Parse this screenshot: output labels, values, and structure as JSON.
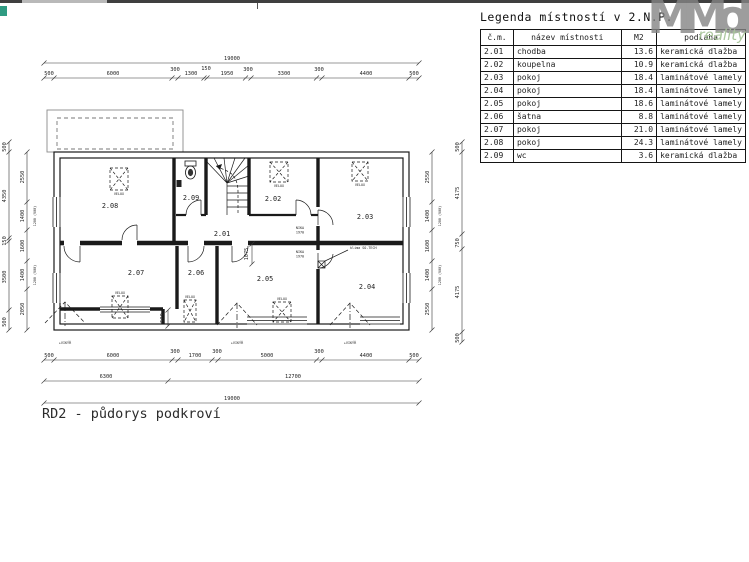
{
  "page": {
    "title_block": "RD2 - půdorys podkroví"
  },
  "watermark": {
    "logo": "MMoli",
    "sub": "reality"
  },
  "legend": {
    "title": "Legenda místností v 2.N.P.",
    "headers": [
      "č.m.",
      "název místnosti",
      "M2",
      "podlaha"
    ],
    "rows": [
      [
        "2.01",
        "chodba",
        "13.6",
        "keramická dlažba"
      ],
      [
        "2.02",
        "koupelna",
        "10.9",
        "keramická dlažba"
      ],
      [
        "2.03",
        "pokoj",
        "18.4",
        "laminátové lamely"
      ],
      [
        "2.04",
        "pokoj",
        "18.4",
        "laminátové lamely"
      ],
      [
        "2.05",
        "pokoj",
        "18.6",
        "laminátové lamely"
      ],
      [
        "2.06",
        "šatna",
        "8.8",
        "laminátové lamely"
      ],
      [
        "2.07",
        "pokoj",
        "21.0",
        "laminátové lamely"
      ],
      [
        "2.08",
        "pokoj",
        "24.3",
        "laminátové lamely"
      ],
      [
        "2.09",
        "wc",
        "3.6",
        "keramická dlažba"
      ]
    ]
  },
  "plan": {
    "rooms": {
      "r201": "2.01",
      "r202": "2.02",
      "r203": "2.03",
      "r204": "2.04",
      "r205": "2.05",
      "r206": "2.06",
      "r207": "2.07",
      "r208": "2.08",
      "r209": "2.09"
    },
    "labels": {
      "velux": "VELUX",
      "vikyr": "+VIKÝŘ",
      "nika_l1": "NIKA",
      "nika_l2": "1970",
      "klima": "klima SO-TECH"
    },
    "dims": {
      "top1": "19000",
      "top2": [
        "500",
        "6000",
        "300",
        "1300",
        "150",
        "1950",
        "300",
        "3300",
        "300",
        "4400",
        "500"
      ],
      "bottom1": [
        "500",
        "6000",
        "300",
        "1700",
        "300",
        "5000",
        "300",
        "4400",
        "500"
      ],
      "bottom2": [
        "6300",
        "12700"
      ],
      "bottom3": "19000",
      "left_inner": [
        "2550",
        "1400",
        "1600",
        "1400",
        "2050"
      ],
      "left_outer": [
        "500",
        "4350",
        "150",
        "3500",
        "500"
      ],
      "left_notes": [
        "1200 (900)",
        "1200 (900)"
      ],
      "right_inner": [
        "2550",
        "1400",
        "1600",
        "1400",
        "2550"
      ],
      "right_notes": [
        "1200 (900)",
        "1200 (900)"
      ],
      "right_outer": [
        "500",
        "4175",
        "750",
        "4175",
        "500"
      ],
      "step": "500",
      "niche": "1075"
    }
  }
}
